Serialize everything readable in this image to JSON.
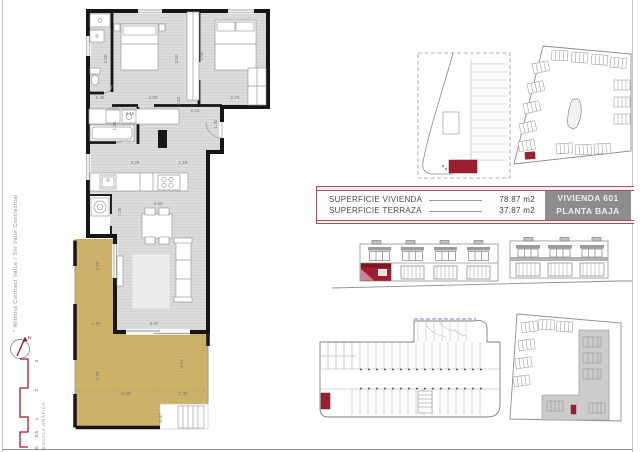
{
  "colors": {
    "accent": "#9c5862",
    "deep_red": "#9e1e2f",
    "terrace": "#cdb269",
    "floor": "#dcdcdc",
    "wall": "#161616",
    "box_gray": "#8d8d8d",
    "dim": "#787878"
  },
  "left_margin": {
    "disclaimer": "* Without Contract Value / Sin Valor Contractual",
    "north_label": "N",
    "scale": {
      "label": "ESCALA GRÁFICA",
      "ticks": [
        "0",
        "0.5",
        "1",
        "2",
        "3"
      ]
    }
  },
  "summary_table": {
    "rows": [
      {
        "label": "SUPERFICIE VIVIENDA",
        "value": "78.87 m2"
      },
      {
        "label": "SUPERFICIE TERRAZA",
        "value": "37.87 m2"
      }
    ],
    "unit_box": {
      "line1": "VIVIENDA 601",
      "line2": "PLANTA BAJA"
    }
  },
  "floorplan": {
    "dimensions": [
      {
        "t": "1.45",
        "x": 50,
        "y": 95,
        "r": 0
      },
      {
        "t": "3.80",
        "x": 57,
        "y": 55,
        "r": -90
      },
      {
        "t": "3.00",
        "x": 103,
        "y": 95,
        "r": 0
      },
      {
        "t": "3.50",
        "x": 128,
        "y": 55,
        "r": -90
      },
      {
        "t": "1.90",
        "x": 153,
        "y": 52,
        "r": -90
      },
      {
        "t": "2.70",
        "x": 185,
        "y": 95,
        "r": 0
      },
      {
        "t": "2.82",
        "x": 130,
        "y": 97,
        "r": -90
      },
      {
        "t": "2.41",
        "x": 145,
        "y": 108,
        "r": 0
      },
      {
        "t": "1.40",
        "x": 167,
        "y": 120,
        "r": -90
      },
      {
        "t": "4.16",
        "x": 80,
        "y": 111,
        "r": 0
      },
      {
        "t": "1.35",
        "x": 66,
        "y": 122,
        "r": -90
      },
      {
        "t": "3.26",
        "x": 85,
        "y": 160,
        "r": 0
      },
      {
        "t": "1.18",
        "x": 133,
        "y": 160,
        "r": 0
      },
      {
        "t": "7.45",
        "x": 71,
        "y": 208,
        "r": -90
      },
      {
        "t": "3.50",
        "x": 108,
        "y": 201,
        "r": 0
      },
      {
        "t": "4.78",
        "x": 49,
        "y": 262,
        "r": -90
      },
      {
        "t": "1.37",
        "x": 46,
        "y": 321,
        "r": 0
      },
      {
        "t": "3.87",
        "x": 104,
        "y": 321,
        "r": 0
      },
      {
        "t": "5.78",
        "x": 49,
        "y": 372,
        "r": -90
      },
      {
        "t": "4.21",
        "x": 133,
        "y": 360,
        "r": -90
      },
      {
        "t": "2.88",
        "x": 76,
        "y": 391,
        "r": 0
      },
      {
        "t": "1.05",
        "x": 133,
        "y": 391,
        "r": 0
      },
      {
        "t": "0.87",
        "x": 112,
        "y": 414,
        "r": -90
      }
    ]
  }
}
